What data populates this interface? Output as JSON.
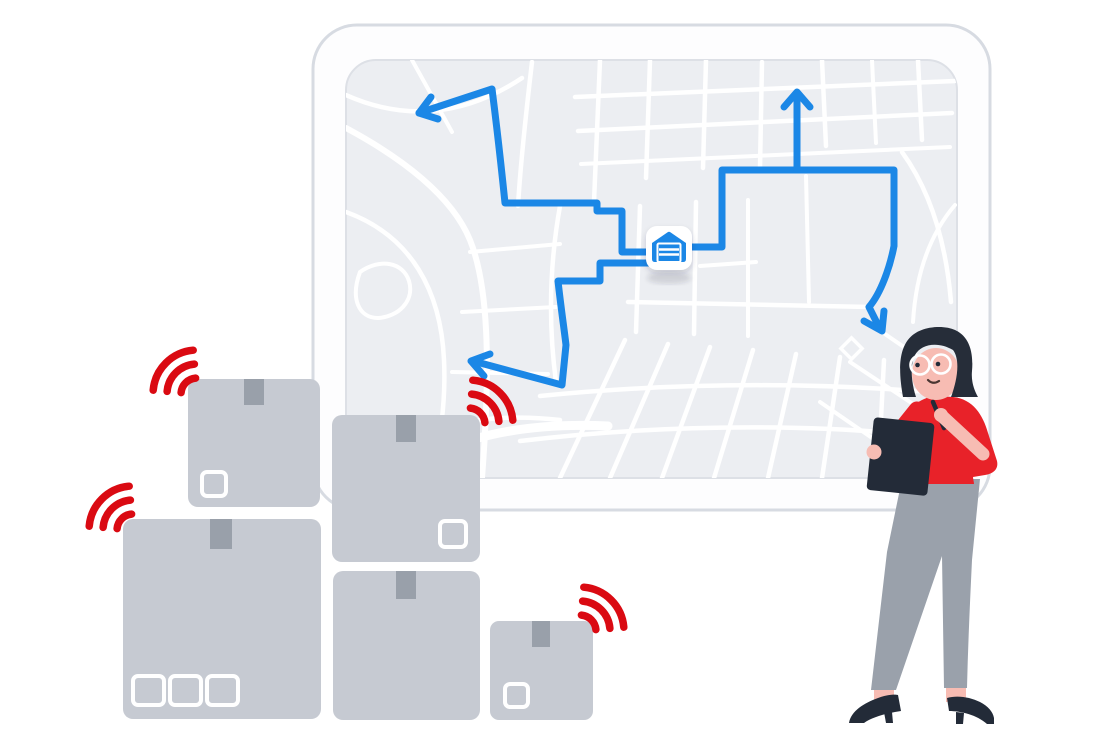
{
  "illustration": {
    "name": "delivery-logistics-scene",
    "background": "#ffffff",
    "width": 1100,
    "height": 740
  },
  "colors": {
    "route_blue": "#1b87e6",
    "warehouse_blue": "#1b87e6",
    "map_bg": "#eceef2",
    "map_border": "#dde0e6",
    "street_white": "#ffffff",
    "frame_fill": "#fdfdfe",
    "frame_border": "#d7dbe2",
    "box_fill": "#c6cad2",
    "tape_fill": "#99a0aa",
    "label_stroke": "#ffffff",
    "signal_red": "#da0a12",
    "hair": "#262d39",
    "skin": "#f7bcb3",
    "shirt": "#e82229",
    "pants": "#9aa1ab",
    "dark_navy": "#232b38",
    "badge_fill": "#ffffff",
    "badge_shadow": "rgba(40,50,70,0.14)",
    "smile": "#4a3632"
  },
  "map_board": {
    "marker_icon": "warehouse-garage-icon",
    "route_arrow_count": 4,
    "route_style": "solid polyline with chevron arrowheads"
  },
  "parcels": {
    "count": 5,
    "with_signal_icon": 3,
    "label_squares_total": 6
  },
  "signals": {
    "count": 4,
    "arcs_per_signal": 3
  },
  "person": {
    "accessories": [
      "glasses",
      "pen",
      "clipboard"
    ],
    "pose": "standing, writing on clipboard"
  }
}
